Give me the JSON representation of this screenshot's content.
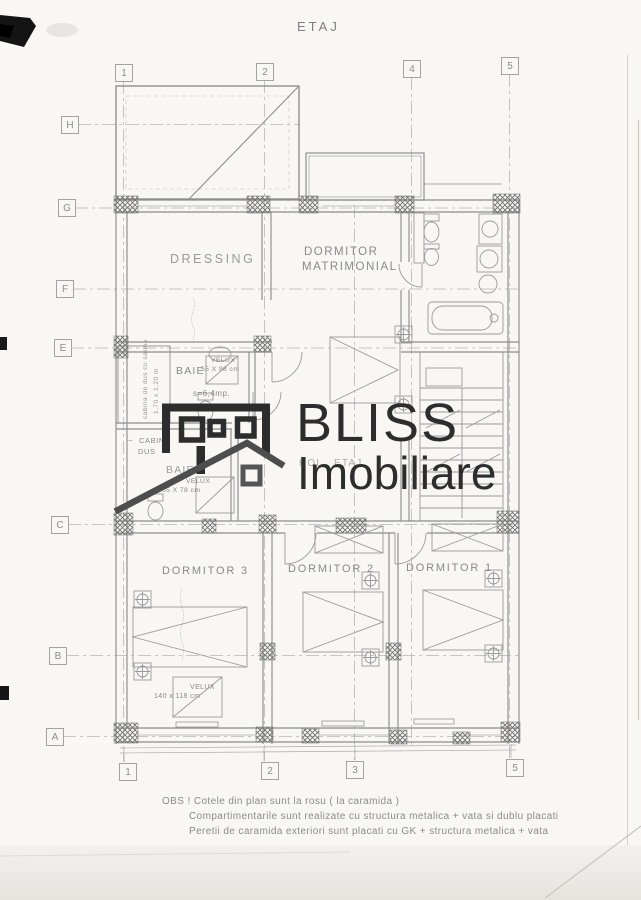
{
  "page": {
    "title": "ETAJ"
  },
  "logo": {
    "name": "BLISS",
    "subtitle": "Imobiliare"
  },
  "grid": {
    "top": [
      "1",
      "2",
      "4",
      "5"
    ],
    "bottom": [
      "1",
      "2",
      "3",
      "5"
    ],
    "left": [
      "H",
      "G",
      "F",
      "E",
      "C",
      "B",
      "A"
    ]
  },
  "rooms": {
    "dressing": "DRESSING",
    "matrimonial_line1": "DORMITOR",
    "matrimonial_line2": "MATRIMONIAL",
    "baie1": "BAIE",
    "baie1_area": "s=6,4mp.",
    "baie2": "BAIE",
    "cabina_line1": "CABINA",
    "cabina_line2": "DUS",
    "cabina_arrow": "→",
    "hol_line1": "HOL",
    "hol_line2": "ETAJ",
    "dormitor3": "DORMITOR 3",
    "dormitor2": "DORMITOR 2",
    "dormitor1": "DORMITOR 1",
    "sauna_note_line1": "cabina de dus cu sauna",
    "sauna_note_line2": "1,70 x 1,20 m"
  },
  "windows": {
    "velux1_line1": "VELUX",
    "velux1_line2": "55 X 98 cm",
    "velux2_line1": "VELUX",
    "velux2_line2": "55 X 78 cm",
    "velux3_line1": "VELUX",
    "velux3_line2": "140 x 118 cm"
  },
  "notes": {
    "obs": "OBS ! Cotele din plan sunt la rosu ( la caramida )",
    "line2": "Compartimentarile sunt realizate cu structura metalica + vata si dublu placati",
    "line3": "Peretii de caramida exteriori sunt placati cu GK + structura metalica + vata"
  },
  "colors": {
    "plan_line": "#8f8f8f",
    "grid_dash": "#b3b3b3",
    "text_gray": "#8a8a8a",
    "logo_ink": "#2d2d2d",
    "paper": "#f8f7f4"
  }
}
